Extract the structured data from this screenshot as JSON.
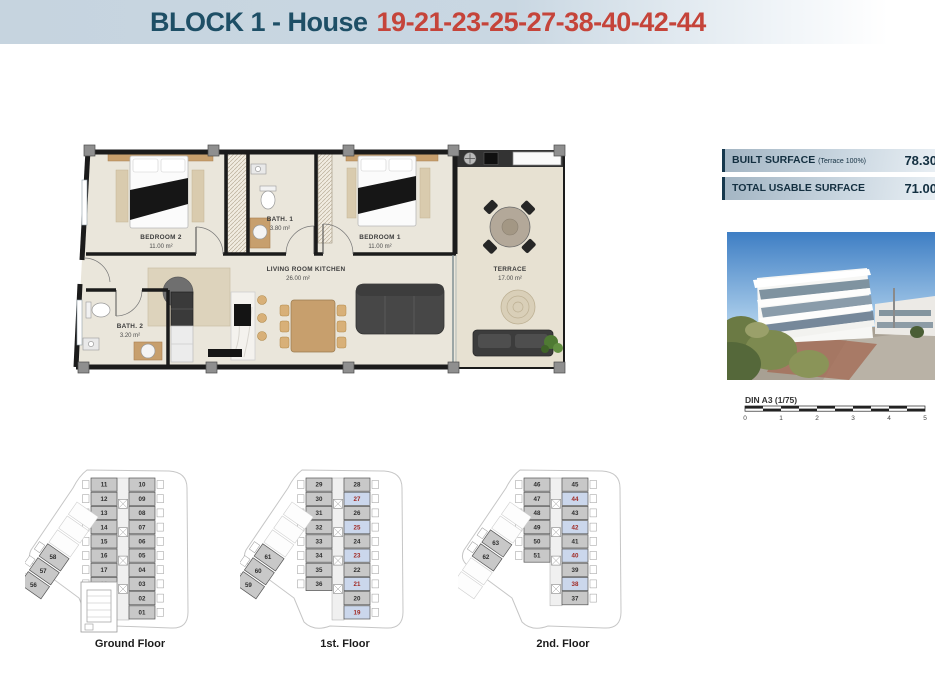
{
  "header": {
    "title_block": "BLOCK 1 - House",
    "title_houses": "19-21-23-25-27-38-40-42-44"
  },
  "surface_table": {
    "rows": [
      {
        "label": "BUILT SURFACE",
        "sublabel": "(Terrace 100%)",
        "value": "78.30"
      },
      {
        "label": "TOTAL USABLE SURFACE",
        "sublabel": "",
        "value": "71.00"
      }
    ]
  },
  "plan": {
    "rooms": [
      {
        "name": "BEDROOM 2",
        "area": "11.00 m²"
      },
      {
        "name": "BATH. 1",
        "area": "3.80 m²"
      },
      {
        "name": "BEDROOM 1",
        "area": "11.00 m²"
      },
      {
        "name": "LIVING ROOM KITCHEN",
        "area": "26.00 m²"
      },
      {
        "name": "BATH. 2",
        "area": "3.20 m²"
      },
      {
        "name": "TERRACE",
        "area": "17.00 m²"
      }
    ]
  },
  "scale_bar": {
    "label": "DIN A3 (1/75)",
    "ticks": [
      "0",
      "1",
      "2",
      "3",
      "4",
      "5"
    ]
  },
  "floors": [
    {
      "label": "Ground Floor",
      "left_units": [
        "11",
        "12",
        "13",
        "14",
        "15",
        "16",
        "17",
        "18"
      ],
      "right_units": [
        "10",
        "09",
        "08",
        "07",
        "06",
        "05",
        "04",
        "03",
        "02",
        "01"
      ],
      "diag_cells": [
        null,
        null,
        null,
        "58",
        "57",
        "56"
      ],
      "highlighted": []
    },
    {
      "label": "1st. Floor",
      "left_units": [
        "29",
        "30",
        "31",
        "32",
        "33",
        "34",
        "35",
        "36"
      ],
      "right_units": [
        "28",
        "27",
        "26",
        "25",
        "24",
        "23",
        "22",
        "21",
        "20",
        "19"
      ],
      "diag_cells": [
        null,
        null,
        null,
        "61",
        "60",
        "59"
      ],
      "highlighted": [
        "27",
        "25",
        "23",
        "21",
        "19"
      ]
    },
    {
      "label": "2nd. Floor",
      "left_units": [
        "46",
        "47",
        "48",
        "49",
        "50",
        "51"
      ],
      "right_units": [
        "45",
        "44",
        "43",
        "42",
        "41",
        "40",
        "39",
        "38",
        "37"
      ],
      "diag_cells": [
        null,
        null,
        "63",
        "62",
        null,
        null
      ],
      "highlighted": [
        "44",
        "42",
        "40",
        "38"
      ]
    }
  ],
  "colors": {
    "navy": "#1e4f66",
    "red": "#c5443a",
    "cell_gray": "#c8c8c8",
    "cell_highlight": "#cbd7ec",
    "highlight_text": "#a02a24",
    "cell_text": "#2e2e2e"
  }
}
